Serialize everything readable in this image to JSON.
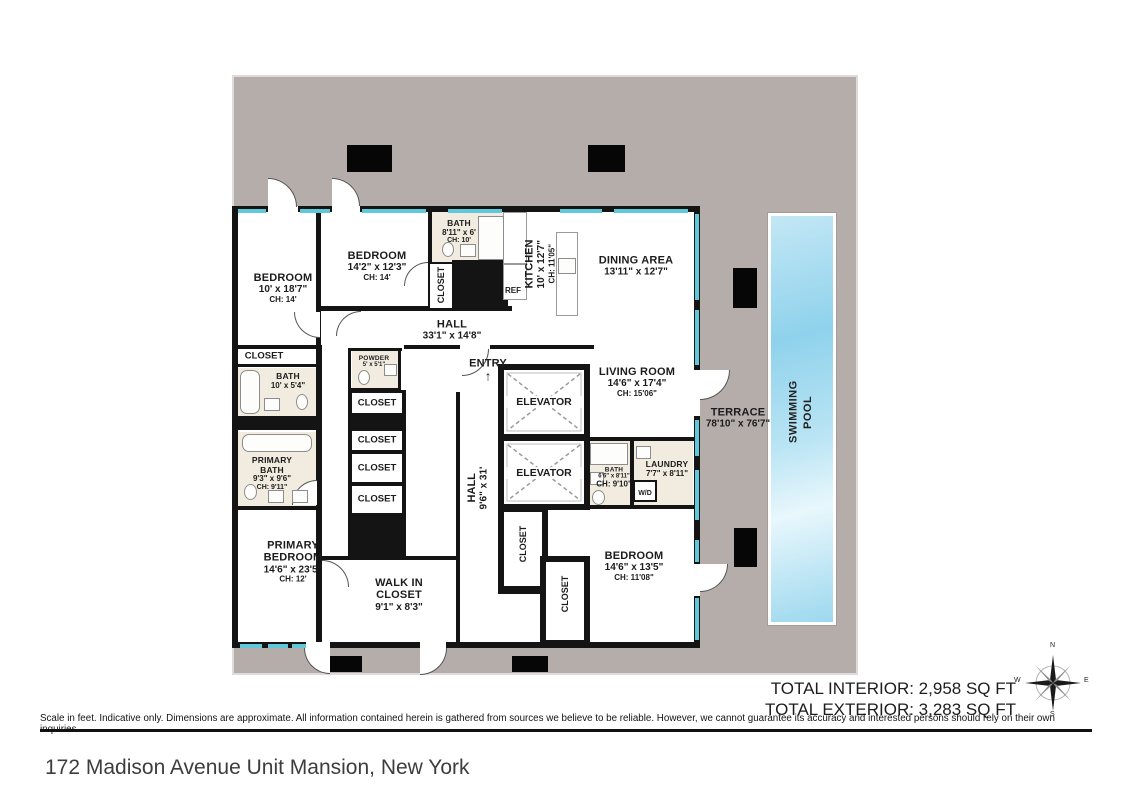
{
  "meta": {
    "address": "172 Madison Avenue Unit Mansion, New York",
    "disclaimer": "Scale in feet. Indicative only. Dimensions are approximate. All information contained herein is gathered from sources we believe to be reliable. However, we cannot guarantee its accuracy and interested persons should rely on their own inquiries .",
    "total_interior": "TOTAL INTERIOR: 2,958 SQ FT",
    "total_exterior": "TOTAL EXTERIOR: 3,283 SQ FT"
  },
  "compass": {
    "n": "N",
    "e": "E",
    "s": "S",
    "w": "W"
  },
  "labels": {
    "closet": "CLOSET",
    "ref": "REF",
    "wd": "W/D",
    "entry_arrow": "↑"
  },
  "colors": {
    "terrace": "#b4adaa",
    "wall": "#141414",
    "window": "#5fc9da",
    "pool": "#8fd2ec",
    "bath_floor": "#f1ecdf"
  },
  "rooms": {
    "bedroom_w": {
      "name": "BEDROOM",
      "dims": "10' x 18'7\"",
      "ch": "CH: 14'"
    },
    "bedroom_n": {
      "name": "BEDROOM",
      "dims": "14'2\" x 12'3\"",
      "ch": "CH: 14'"
    },
    "bath_n": {
      "name": "BATH",
      "dims": "8'11\" x 6'",
      "ch": "CH: 10'"
    },
    "kitchen": {
      "name": "KITCHEN",
      "dims": "10' x 12'7\"",
      "ch": "CH: 11'05\""
    },
    "dining": {
      "name": "DINING AREA",
      "dims": "13'11\" x 12'7\""
    },
    "hall_n": {
      "name": "HALL",
      "dims": "33'1\" x 14'8\""
    },
    "entry": {
      "name": "ENTRY"
    },
    "bath_w": {
      "name": "BATH",
      "dims": "10' x 5'4\""
    },
    "powder": {
      "name": "POWDER",
      "dims": "5' x 5'1\""
    },
    "living": {
      "name": "LIVING ROOM",
      "dims": "14'6\" x 17'4\"",
      "ch": "CH: 15'06\""
    },
    "elevator": {
      "name": "ELEVATOR"
    },
    "hall_s": {
      "name": "HALL",
      "dims": "9'6\" x 31'"
    },
    "primary_bath": {
      "name": "PRIMARY BATH",
      "dims": "9'3\" x 9'6\"",
      "ch": "CH: 9'11\""
    },
    "primary_bedroom": {
      "name": "PRIMARY BEDROOM",
      "dims": "14'6\" x 23'5\"",
      "ch": "CH: 12'"
    },
    "walk_in": {
      "name": "WALK IN CLOSET",
      "dims": "9'1\" x 8'3\""
    },
    "bath_s": {
      "name": "BATH",
      "dims": "6'6\" x 8'11\"",
      "ch": "CH: 9'10\""
    },
    "laundry": {
      "name": "LAUNDRY",
      "dims": "7'7\" x 8'11\""
    },
    "bedroom_s": {
      "name": "BEDROOM",
      "dims": "14'6\" x 13'5\"",
      "ch": "CH: 11'08\""
    },
    "terrace": {
      "name": "TERRACE",
      "dims": "78'10\" x 76'7\""
    },
    "pool": {
      "name": "SWIMMING POOL"
    }
  }
}
